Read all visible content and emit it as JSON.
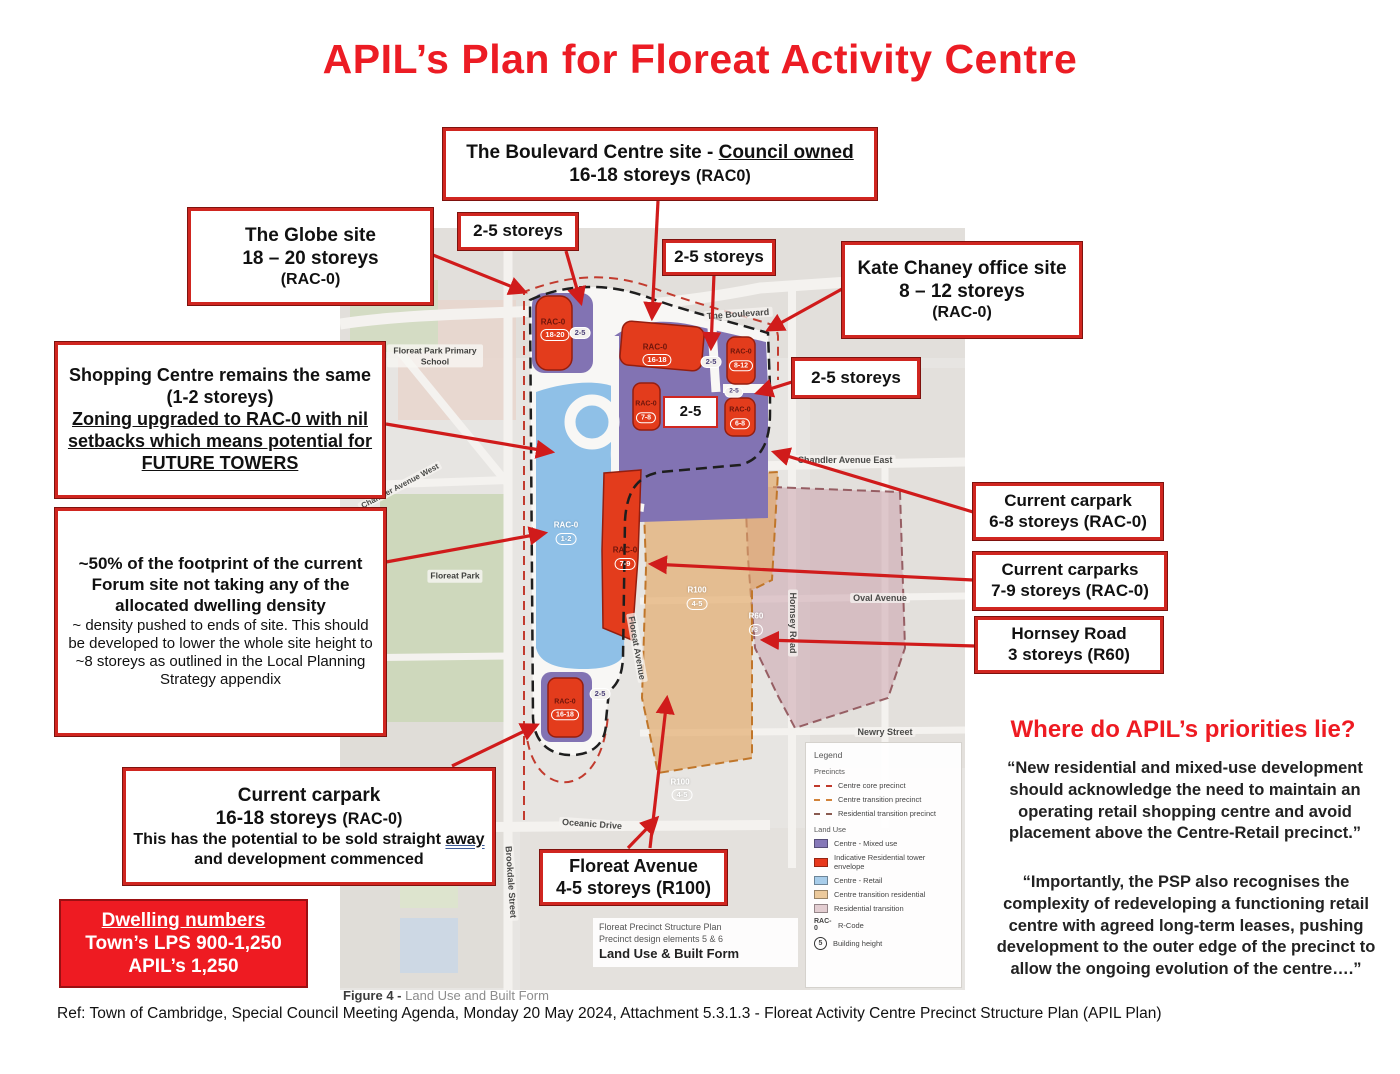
{
  "title": "APIL’s Plan for Floreat Activity Centre",
  "callouts": {
    "boulevard": {
      "l1a": "The Boulevard Centre site - ",
      "l1b": "Council owned",
      "l2a": "16-18 storeys ",
      "l2b": "(RAC0)"
    },
    "globe": {
      "l1": "The Globe site",
      "l2": "18 – 20 storeys",
      "l3": "(RAC-0)"
    },
    "storeys_nw": {
      "label": "2-5 storeys"
    },
    "storeys_n": {
      "label": "2-5 storeys"
    },
    "storeys_e": {
      "label": "2-5 storeys"
    },
    "kate": {
      "l1": "Kate Chaney office site",
      "l2": "8 – 12 storeys",
      "l3": "(RAC-0)"
    },
    "shopping": {
      "l1": "Shopping Centre remains the same (1-2 storeys)",
      "l2": "Zoning upgraded to RAC-0 with nil setbacks which means potential for FUTURE TOWERS"
    },
    "footprint": {
      "l1": "~50% of the footprint of the current Forum site not taking any of the allocated dwelling density",
      "l2": "~ density pushed to ends of site. This should be developed to lower the whole site height to ~8 storeys as outlined in the Local Planning Strategy appendix"
    },
    "carpark_sw": {
      "l1": "Current carpark",
      "l2a": "16-18 storeys ",
      "l2b": "(RAC-0)",
      "l3a": "This has the potential to be sold straight ",
      "l3b": "away",
      "l3c": " and development commenced"
    },
    "dwelling": {
      "l1": "Dwelling numbers",
      "l2": "Town’s LPS 900-1,250",
      "l3": "APIL’s 1,250"
    },
    "carpark_e1": {
      "l1": "Current carpark",
      "l2": "6-8 storeys (RAC-0)"
    },
    "carpark_e2": {
      "l1": "Current carparks",
      "l2": "7-9 storeys (RAC-0)"
    },
    "hornsey": {
      "l1": "Hornsey Road",
      "l2": "3 storeys (R60)"
    },
    "floreat_ave": {
      "l1": "Floreat Avenue",
      "l2": "4-5 storeys (R100)"
    },
    "inmap_25": {
      "label": "2-5"
    }
  },
  "priorities": {
    "heading": "Where do APIL’s priorities lie?",
    "quote1": "“New residential and mixed-use development should acknowledge the need to maintain an operating retail shopping centre and avoid placement above the Centre-Retail precinct.”",
    "quote2": "“Importantly, the PSP also recognises the complexity of redeveloping a functioning retail centre with agreed long-term leases, pushing development to the outer edge of the precinct to allow the ongoing evolution of the centre….”"
  },
  "map": {
    "places": {
      "school": "Floreat Park Primary School",
      "park": "Floreat Park"
    },
    "streets": {
      "boulevard": "The Boulevard",
      "chandler_east": "Chandler Avenue East",
      "chandler_west": "Chandler Avenue West",
      "oval": "Oval Avenue",
      "hornsey": "Hornsey Road",
      "newry": "Newry Street",
      "oceanic": "Oceanic Drive",
      "brookdale": "Brookdale Street",
      "floreat": "Floreat Avenue"
    },
    "zones": {
      "retail": {
        "code": "RAC-0",
        "height": "1-2"
      },
      "tower_nw": {
        "code": "RAC-0",
        "height": "18-20"
      },
      "purple_nw": {
        "height": "2-5"
      },
      "tower_n": {
        "code": "RAC-0",
        "height": "16-18"
      },
      "purple_n": {
        "height": "2-5"
      },
      "tower_e": {
        "code": "RAC-0",
        "height": "8-12"
      },
      "purple_e": {
        "height": "2-5"
      },
      "tower_se": {
        "code": "RAC-0",
        "height": "6-8"
      },
      "tower_w": {
        "code": "RAC-0",
        "height": "7-8"
      },
      "tower_mid": {
        "code": "RAC-0",
        "height": "7-9"
      },
      "tower_s": {
        "code": "RAC-0",
        "height": "16-18"
      },
      "purple_s": {
        "height": "2-5"
      },
      "orange_n": {
        "code": "R100",
        "height": "4-5"
      },
      "orange_s": {
        "code": "R100",
        "height": "4-5"
      },
      "mauve": {
        "code": "R60",
        "height": "3"
      }
    },
    "legend": {
      "title": "Legend",
      "precincts_title": "Precincts",
      "precincts": [
        {
          "label": "Centre core precinct",
          "color": "#c0392b"
        },
        {
          "label": "Centre transition precinct",
          "color": "#d2833a"
        },
        {
          "label": "Residential transition precinct",
          "color": "#8a5a50"
        }
      ],
      "landuse_title": "Land Use",
      "landuse": [
        {
          "label": "Centre - Mixed use",
          "color": "#8678b8"
        },
        {
          "label": "Indicative Residential tower envelope",
          "color": "#e8391d"
        },
        {
          "label": "Centre - Retail",
          "color": "#a8cdea"
        },
        {
          "label": "Centre transition residential",
          "color": "#ecc99b"
        },
        {
          "label": "Residential transition",
          "color": "#e3cdd1"
        }
      ],
      "rcode_label": "RAC-0",
      "rcode_text": "R-Code",
      "height_symbol": "5",
      "height_text": "Building height"
    },
    "attribution": {
      "l1": "Floreat Precinct Structure Plan",
      "l2": "Precinct design elements 5 & 6",
      "l3": "Land Use & Built Form"
    }
  },
  "footer": {
    "figure_bold": "Figure 4 -",
    "figure_rest": " Land Use and Built Form",
    "ref": "Ref:  Town of Cambridge, Special Council Meeting Agenda, Monday 20 May 2024, Attachment 5.3.1.3 - Floreat Activity Centre Precinct Structure Plan (APIL Plan)"
  },
  "colors": {
    "accent_red": "#ec1c24",
    "box_border": "#d02620",
    "arrow": "#d01b1b",
    "mixed_use": "#8273b3",
    "tower": "#e33c1c",
    "retail": "#8fc0e7",
    "transition_residential": "#e2a45f",
    "residential_transition": "#c9a0aa"
  }
}
